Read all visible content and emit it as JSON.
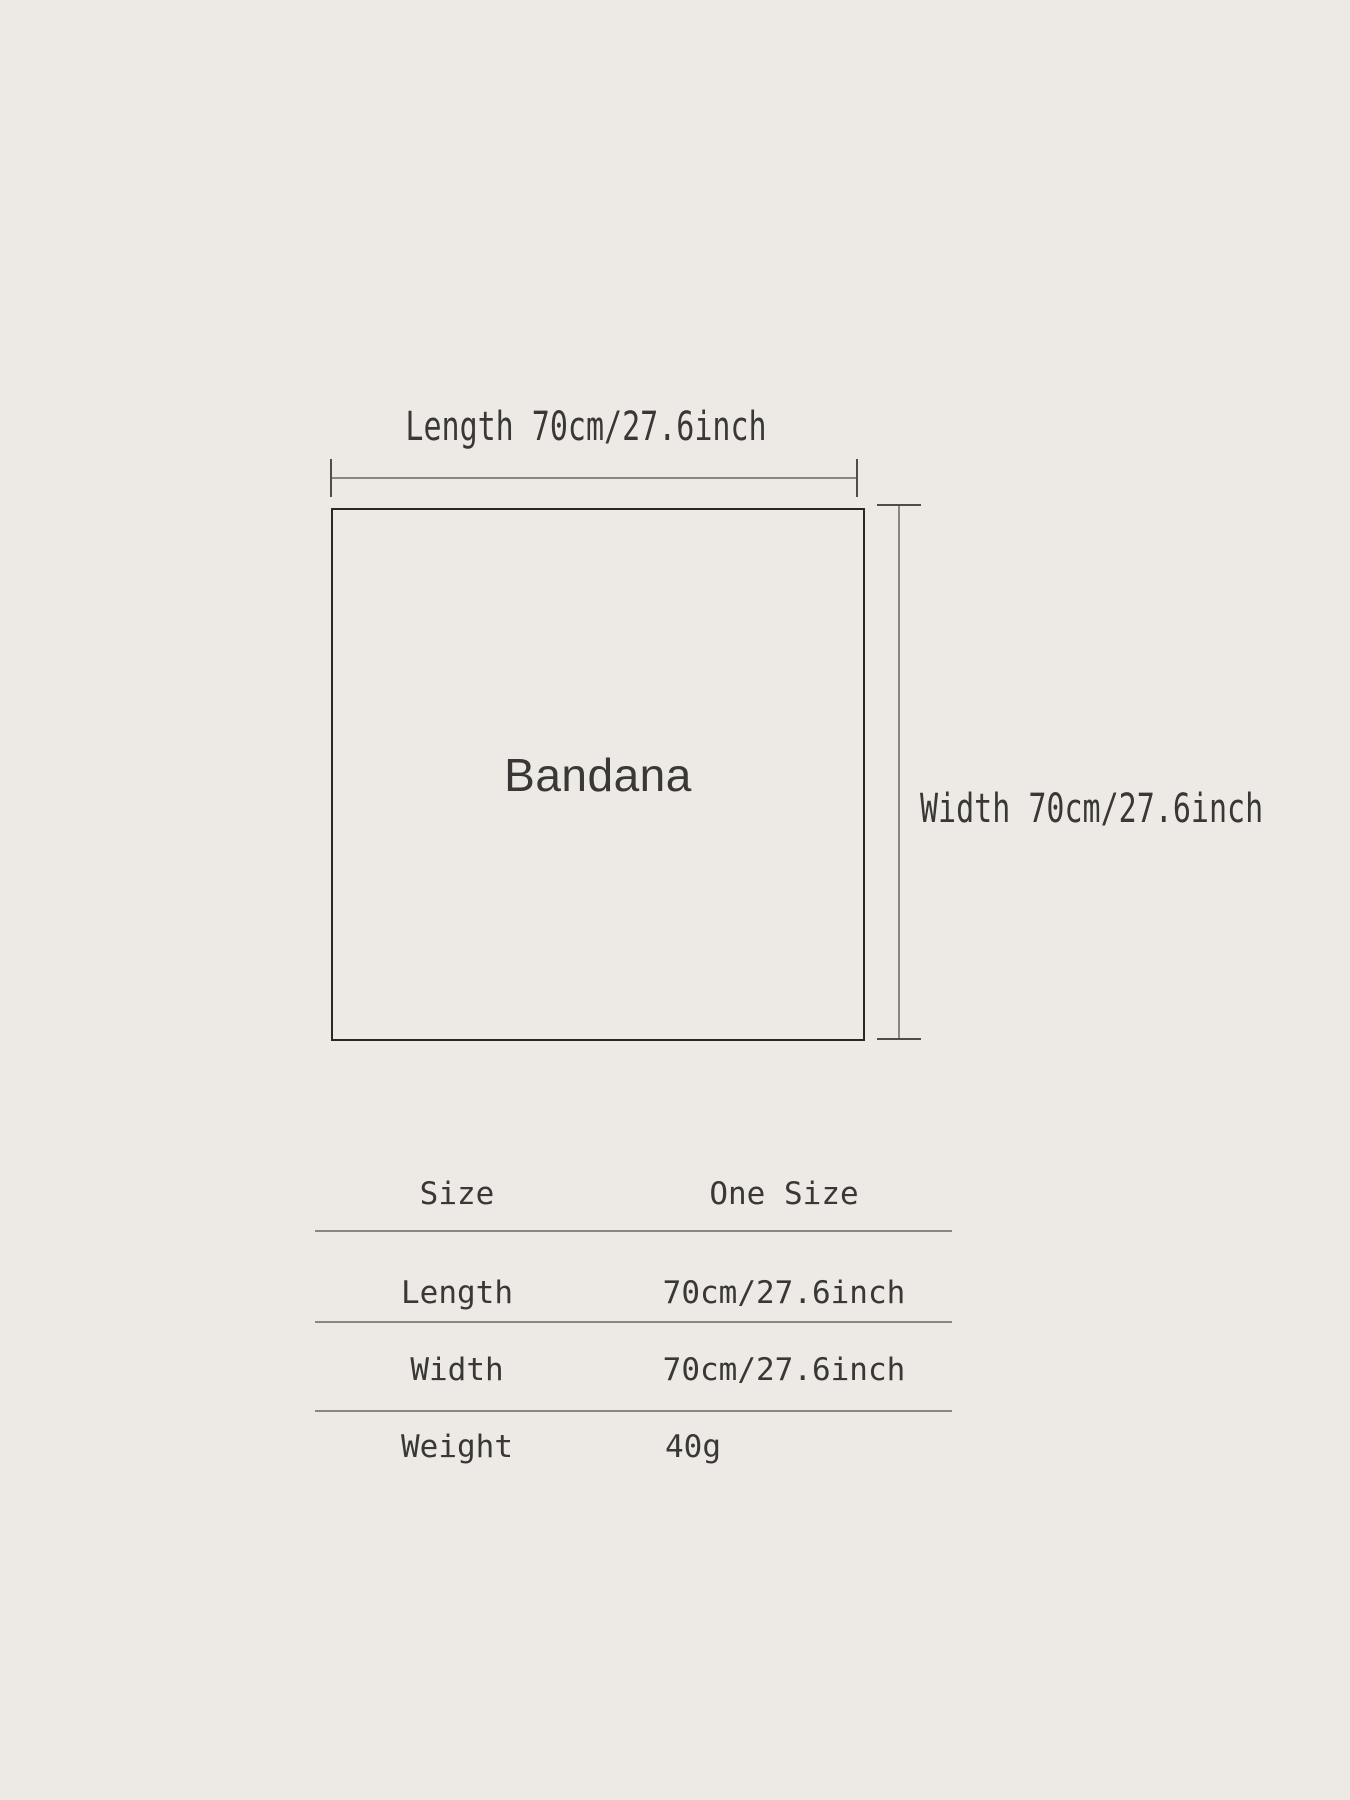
{
  "diagram": {
    "product_name": "Bandana",
    "length_label": "Length 70cm/27.6inch",
    "width_label": "Width 70cm/27.6inch"
  },
  "size_table": {
    "header": {
      "label": "Size",
      "value": "One Size"
    },
    "rows": [
      {
        "label": "Length",
        "value": "70cm/27.6inch"
      },
      {
        "label": "Width",
        "value": "70cm/27.6inch"
      },
      {
        "label": "Weight",
        "value": "40g"
      }
    ]
  },
  "colors": {
    "background": "#edeae5",
    "text": "#3a3836",
    "square_border": "#2a2825",
    "measure_line": "#8a8680",
    "measure_tick": "#504d49",
    "table_divider": "#8b8780"
  }
}
